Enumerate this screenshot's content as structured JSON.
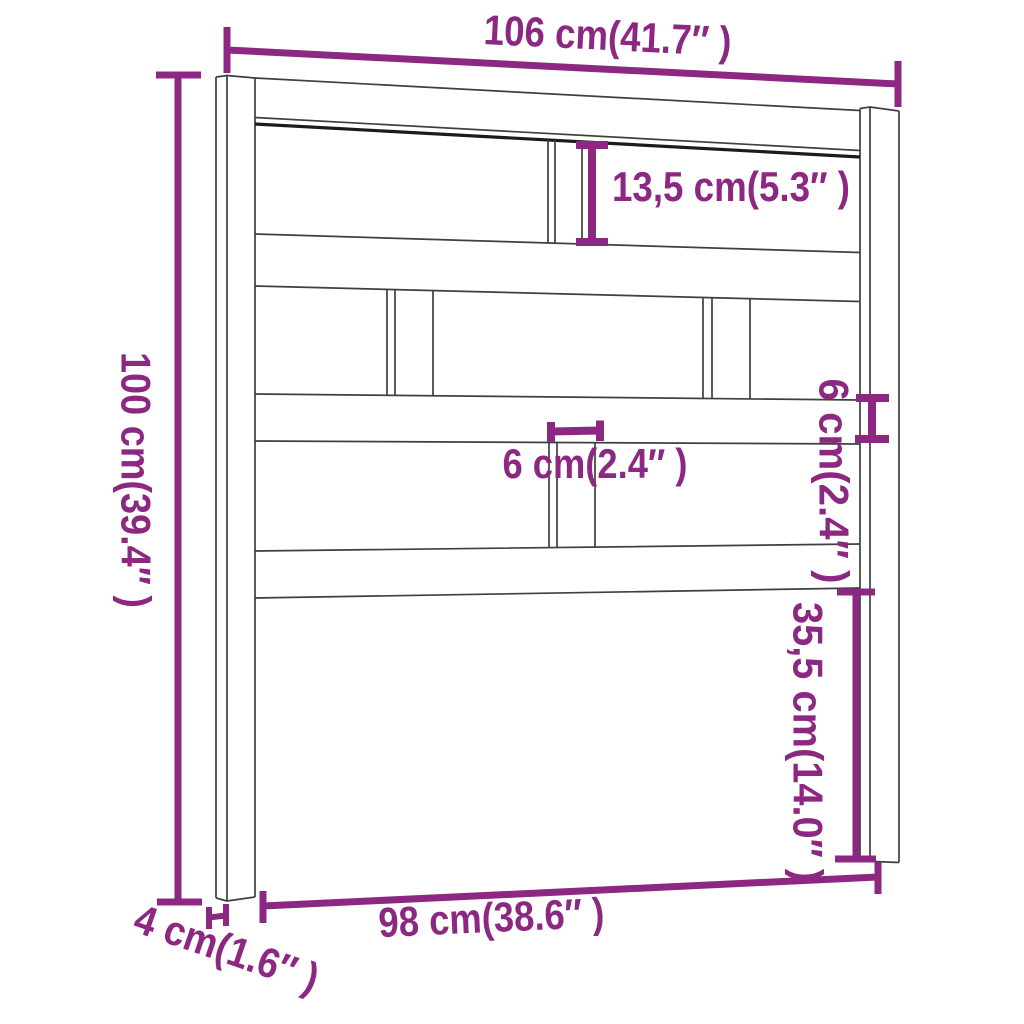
{
  "page": {
    "background_color": "#ffffff"
  },
  "diagram": {
    "accent_color": "#8C2882",
    "line_color": "#3f3f3f",
    "dark_line_color": "#1b1b1b",
    "dimensions": {
      "overall_width": "106 cm(41.7″ )",
      "overall_height": "100 cm(39.4″ )",
      "top_gap_height": "13,5 cm(5.3″ )",
      "slat_width": "6 cm(2.4″ )",
      "rail_thickness": "6 cm(2.4″ )",
      "lower_gap_height": "35,5 cm(14.0″ )",
      "inner_width": "98 cm(38.6″ )",
      "post_depth": "4 cm(1.6″ )"
    }
  }
}
